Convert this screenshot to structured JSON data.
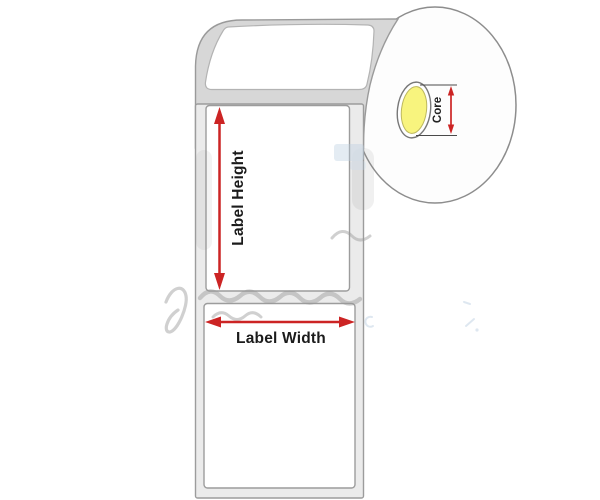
{
  "diagram": {
    "annotations": {
      "label_height": "Label Height",
      "label_width": "Label Width",
      "core": "Core"
    },
    "colors": {
      "arrow_red": "#cc2424",
      "core_yellow": "#f8f47e",
      "roll_surface_gray": "#d7d7d7",
      "liner_gray": "#ebebeb",
      "outline_gray": "#9a9a9a"
    }
  }
}
